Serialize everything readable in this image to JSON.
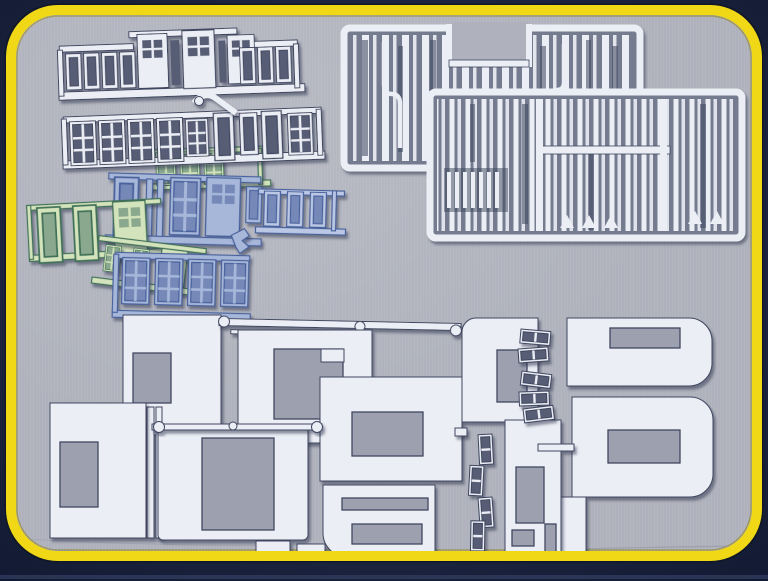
{
  "meta": {
    "description": "Box-art photograph of architectural model kit sprues on a grey studio backdrop inside a rounded yellow frame"
  },
  "colors": {
    "navy": "#1d2642",
    "navy_deep": "#101828",
    "navy_strip": "#334062",
    "yellow": "#f0d816",
    "yellow_shade": "#8c7b10",
    "photo_bg": "#afb2bc",
    "photo_hole": "#9da1af",
    "white": "#eceef5",
    "outline": "#3f4760",
    "void_dark": "#565d74",
    "trim_bg": "#757c90",
    "trim_dark": "#3e455c",
    "green": "#d3e3bb",
    "green_dark": "#3f7159",
    "green_void": "#8aa88e",
    "blue": "#a6b7da",
    "blue_light": "#bac7e5",
    "blue_dark": "#4a629c",
    "blue_void": "#7488b8"
  },
  "scene": {
    "frame": {
      "label": "rounded yellow border frame"
    },
    "backdrop": {
      "label": "grey studio background"
    },
    "parts": [
      {
        "id": "window-sprue-row-1",
        "label": "white sprue of small sash-window and door frames",
        "color_key": "white"
      },
      {
        "id": "window-sprue-row-2",
        "label": "white sprue of multi-pane window frames and door frames",
        "color_key": "white"
      },
      {
        "id": "green-window-sprue-back",
        "label": "pale green sprue of small multi-pane windows",
        "color_key": "green"
      },
      {
        "id": "green-window-sprue-front",
        "label": "pale green sprue of large window frames and door panel",
        "color_key": "green"
      },
      {
        "id": "green-window-sprue-small",
        "label": "pale green sprue of two small grid windows",
        "color_key": "green"
      },
      {
        "id": "blue-window-sprue-main",
        "label": "light blue sprue of tall window and door frames",
        "color_key": "blue"
      },
      {
        "id": "blue-window-sprue-louver",
        "label": "light blue sprue of four louvered window frames",
        "color_key": "blue"
      },
      {
        "id": "trim-sprue-upper",
        "label": "white sprue of long trim and moulding strips (upper)",
        "color_key": "white"
      },
      {
        "id": "trim-sprue-lower",
        "label": "white sprue of long trim and moulding strips (lower)",
        "color_key": "white"
      },
      {
        "id": "wall-panel-group",
        "label": "large white wall panels with window and door cut-outs joined by runners",
        "color_key": "white"
      },
      {
        "id": "small-detail-sprue",
        "label": "column of tiny white detail frames",
        "color_key": "white"
      }
    ]
  }
}
